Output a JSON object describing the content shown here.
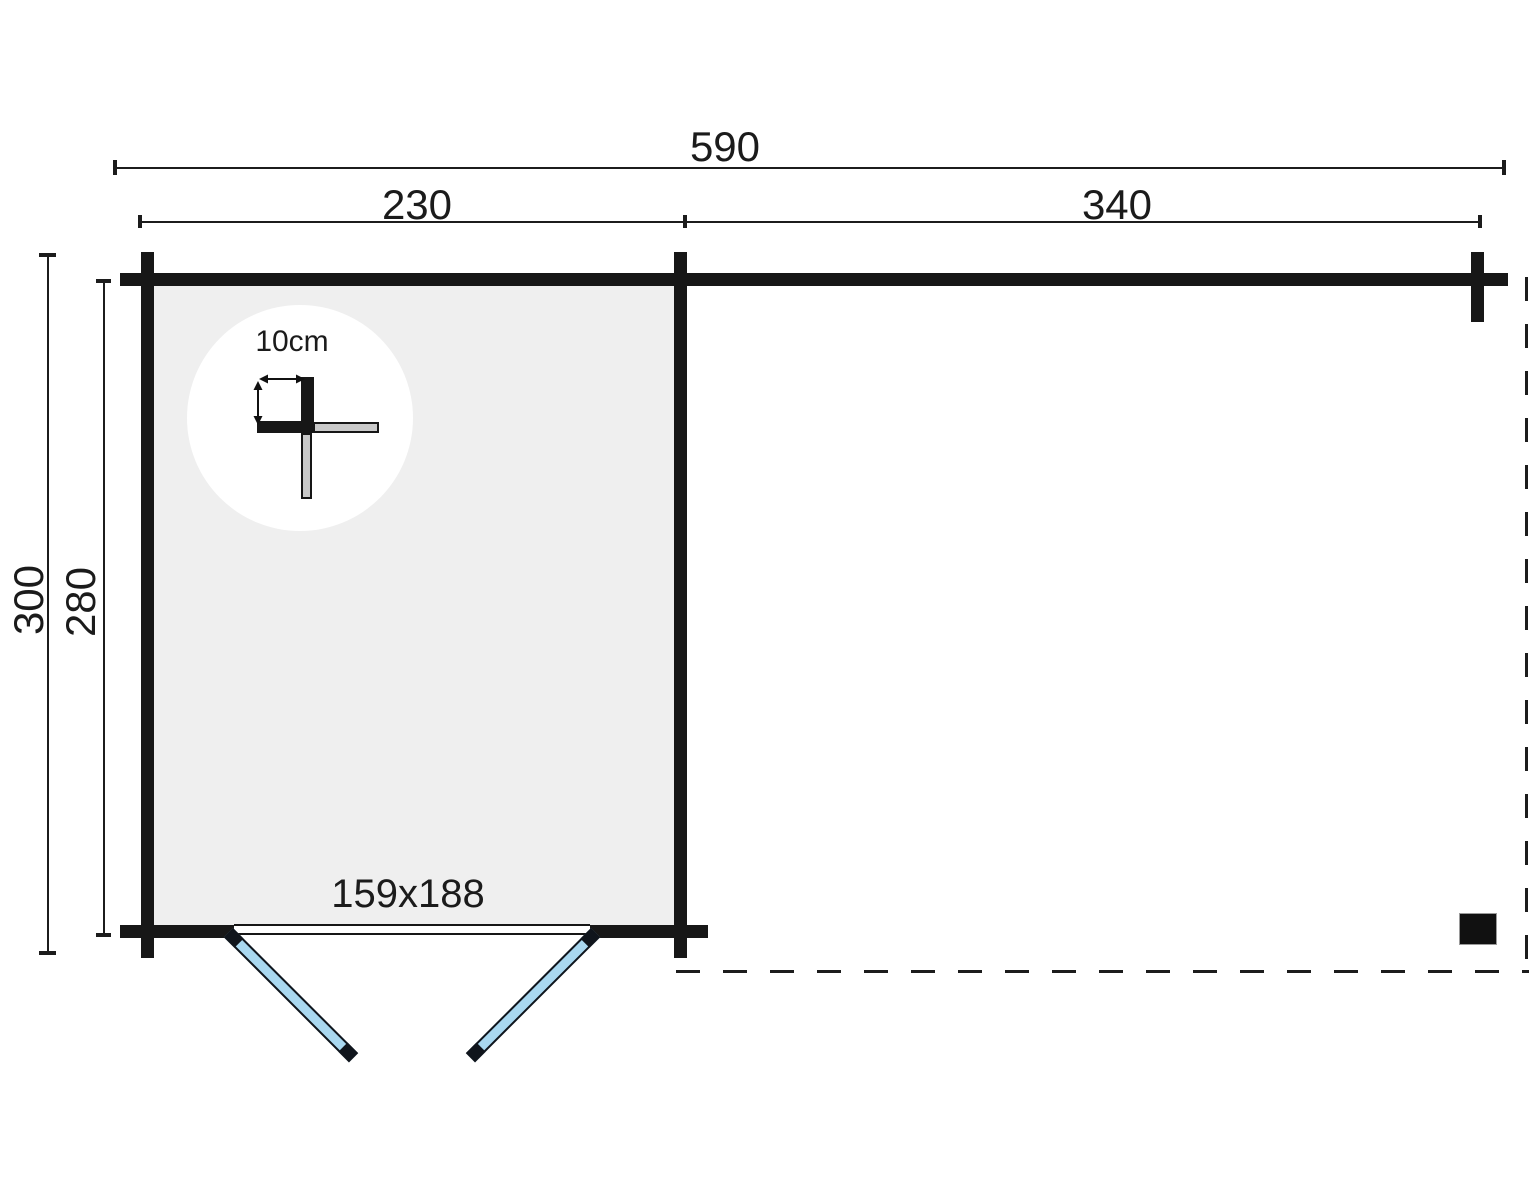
{
  "plan": {
    "dimensions": {
      "total_width": "590",
      "left_section_width": "230",
      "right_section_width": "340",
      "outer_depth": "300",
      "inner_depth": "280"
    },
    "door": {
      "size": "159x188"
    },
    "detail": {
      "wall_thickness": "10cm"
    },
    "colors": {
      "wall": "#171717",
      "floor": "#efefef",
      "door": "#a9d8f0",
      "log_gray": "#c9c9c9",
      "bg": "#ffffff"
    }
  }
}
